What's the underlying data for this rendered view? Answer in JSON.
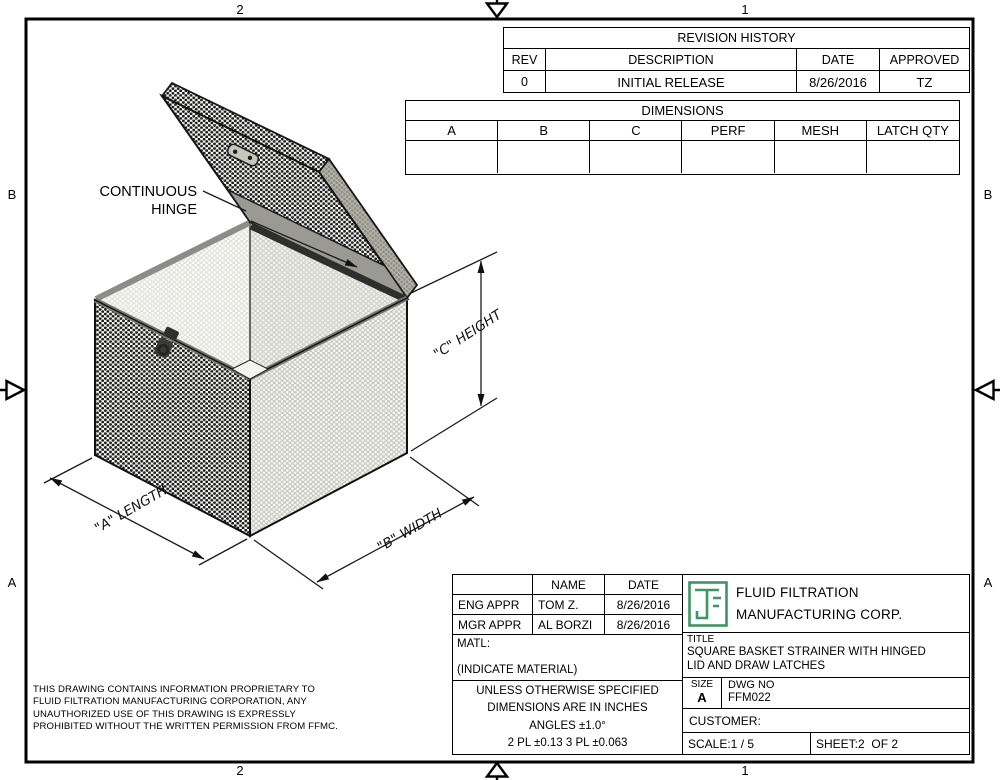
{
  "sheet": {
    "zones": {
      "top": [
        "2",
        "1"
      ],
      "bottom": [
        "2",
        "1"
      ],
      "left": [
        "B",
        "A"
      ],
      "right": [
        "B",
        "A"
      ]
    }
  },
  "revision_table": {
    "title": "REVISION HISTORY",
    "columns": [
      "REV",
      "DESCRIPTION",
      "DATE",
      "APPROVED"
    ],
    "rows": [
      {
        "rev": "0",
        "description": "INITIAL RELEASE",
        "date": "8/26/2016",
        "approved": "TZ"
      }
    ]
  },
  "dimensions_table": {
    "title": "DIMENSIONS",
    "columns": [
      "A",
      "B",
      "C",
      "PERF",
      "MESH",
      "LATCH QTY"
    ],
    "rows": [
      {
        "a": "",
        "b": "",
        "c": "",
        "perf": "",
        "mesh": "",
        "latch_qty": ""
      }
    ]
  },
  "drawing": {
    "callout": {
      "line1": "CONTINUOUS",
      "line2": "HINGE"
    },
    "dimensions": {
      "height": "\"C\" HEIGHT",
      "length": "\"A\" LENGTH",
      "width": "\"B\" WIDTH"
    }
  },
  "title_block": {
    "approvals": {
      "name_header": "NAME",
      "date_header": "DATE",
      "rows": [
        {
          "role": "ENG APPR",
          "name": "TOM Z.",
          "date": "8/26/2016"
        },
        {
          "role": "MGR APPR",
          "name": "AL BORZI",
          "date": "8/26/2016"
        }
      ]
    },
    "material": {
      "label": "MATL:",
      "value": "(INDICATE MATERIAL)"
    },
    "tolerances": [
      "UNLESS OTHERWISE SPECIFIED",
      "DIMENSIONS ARE IN INCHES",
      "ANGLES ±1.0°",
      "2 PL ±0.13 3 PL ±0.063"
    ],
    "company": {
      "name_line1": "FLUID FILTRATION",
      "name_line2": "MANUFACTURING CORP."
    },
    "title": {
      "label": "TITLE",
      "line1": "SQUARE BASKET STRAINER WITH HINGED",
      "line2": "LID AND DRAW LATCHES"
    },
    "size": {
      "label": "SIZE",
      "value": "A"
    },
    "dwg_no": {
      "label": "DWG NO",
      "value": "FFM022"
    },
    "customer_label": "CUSTOMER:",
    "scale": "SCALE:1 / 5",
    "sheet_of": "SHEET:2  OF 2"
  },
  "proprietary_notice": {
    "lines": [
      "THIS DRAWING CONTAINS INFORMATION PROPRIETARY TO",
      "FLUID FILTRATION MANUFACTURING CORPORATION, ANY",
      "UNAUTHORIZED USE OF THIS DRAWING IS EXPRESSLY",
      "PROHIBITED WITHOUT THE WRITTEN PERMISSION FROM FFMC."
    ]
  },
  "colors": {
    "line": "#000000",
    "logo_green": "#3f9464",
    "rim_gray": "#8d8d85",
    "hinge_dark": "#2e2e2c"
  }
}
